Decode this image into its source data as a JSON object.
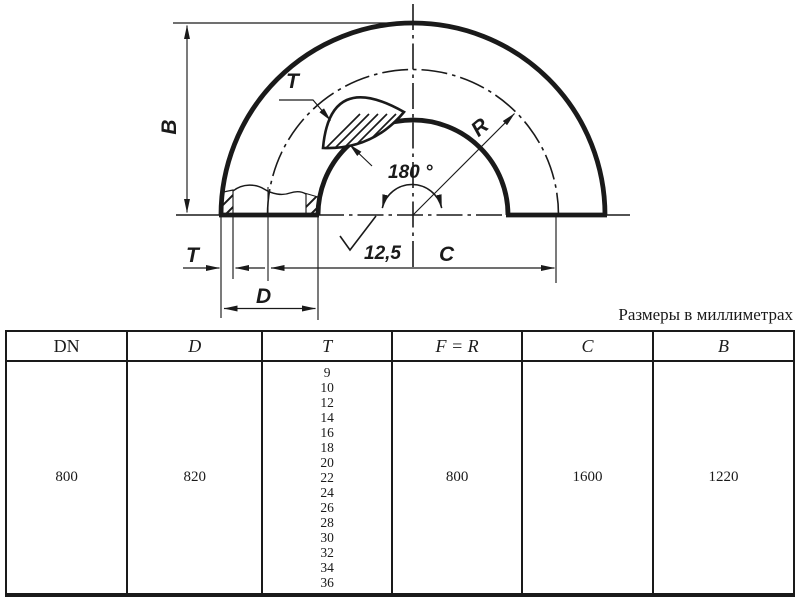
{
  "colors": {
    "ink": "#1a1a1a",
    "background": "#ffffff"
  },
  "drawing": {
    "labels": {
      "b": "B",
      "t_top": "T",
      "t_bottom": "T",
      "d": "D",
      "c": "C",
      "r": "R",
      "angle": "180 °",
      "roughness": "12,5"
    }
  },
  "table": {
    "note": "Размеры в миллиметрах",
    "headers": [
      "DN",
      "D",
      "T",
      "F = R",
      "C",
      "B"
    ],
    "row": {
      "dn": "800",
      "d": "820",
      "t_values": [
        "9",
        "10",
        "12",
        "14",
        "16",
        "18",
        "20",
        "22",
        "24",
        "26",
        "28",
        "30",
        "32",
        "34",
        "36"
      ],
      "f_r": "800",
      "c": "1600",
      "b": "1220"
    }
  }
}
